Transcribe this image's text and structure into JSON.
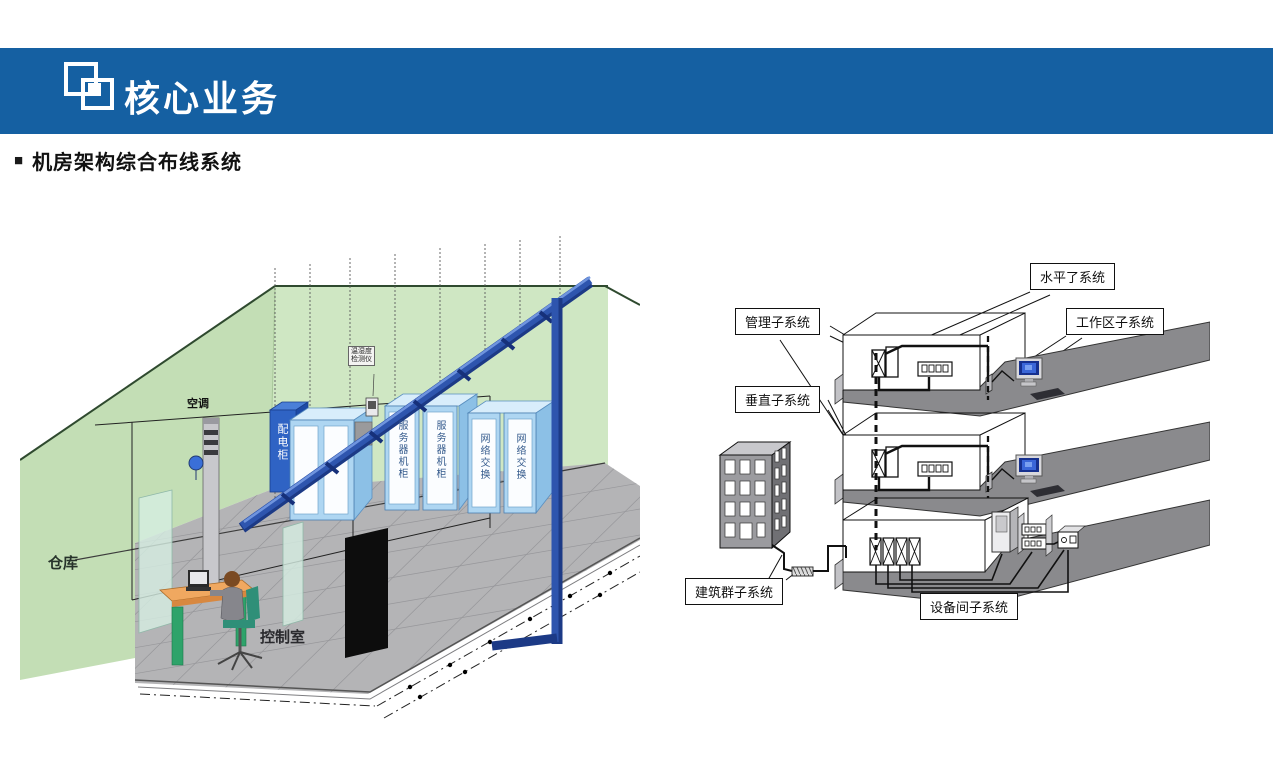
{
  "header": {
    "title": "核心业务"
  },
  "section": {
    "bullet": "■",
    "title": "机房架构综合布线系统"
  },
  "colors": {
    "header_bg": "#1560a2",
    "wall_green": "#cfe7c3",
    "tray_blue": "#2e55ae",
    "cabinet_blue": "#aed6f2",
    "power_cabinet_blue": "#2f63c4",
    "floor_gray": "#b4b4b6",
    "right_floor_gray": "#8a8a8d",
    "screen_blue": "#3a66d8"
  },
  "left_diagram": {
    "labels": {
      "ac": "空调",
      "warehouse": "仓库",
      "control_room": "控制室",
      "power_cabinet": "配电柜",
      "server_rack": "服务器机柜",
      "network_switch": "网络交换",
      "sensor_line1": "温湿度",
      "sensor_line2": "检测仪"
    }
  },
  "right_diagram": {
    "labels": {
      "horizontal": "水平了系统",
      "management": "管理子系统",
      "work_area": "工作区子系统",
      "vertical": "垂直子系统",
      "campus": "建筑群子系统",
      "equipment_room": "设备间子系统"
    }
  }
}
